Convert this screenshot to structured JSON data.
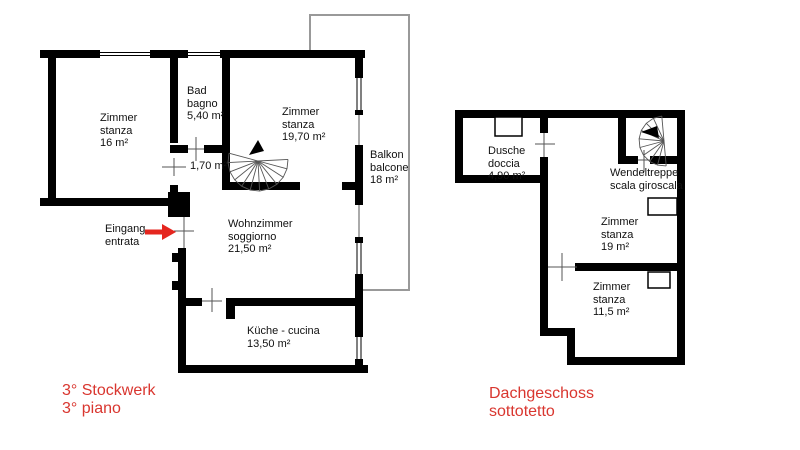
{
  "colors": {
    "wall": "#000000",
    "accent_red_text": "#d9362f",
    "arrow_red": "#e5261f",
    "balcony_outline": "#999999"
  },
  "left_plan": {
    "caption": {
      "line1": "3° Stockwerk",
      "line2": "3° piano"
    },
    "entrance": {
      "line1": "Eingang",
      "line2": "entrata"
    },
    "hallway_area": "1,70 m²",
    "rooms": [
      {
        "name_de": "Zimmer",
        "name_it": "stanza",
        "area": "16 m²"
      },
      {
        "name_de": "Bad",
        "name_it": "bagno",
        "area": "5,40 m²"
      },
      {
        "name_de": "Zimmer",
        "name_it": "stanza",
        "area": "19,70 m²"
      },
      {
        "name_de": "Balkon",
        "name_it": "balcone",
        "area": "18 m²"
      },
      {
        "name_de": "Wohnzimmer",
        "name_it": "soggiorno",
        "area": "21,50 m²"
      },
      {
        "name_de": "Küche - cucina",
        "name_it": "",
        "area": "13,50 m²"
      }
    ]
  },
  "right_plan": {
    "caption": {
      "line1": "Dachgeschoss",
      "line2": "sottotetto"
    },
    "stair_label": {
      "line1": "Wendeltreppe",
      "line2": "scala giroscala"
    },
    "rooms": [
      {
        "name_de": "Dusche",
        "name_it": "doccia",
        "area": "4,90 m²"
      },
      {
        "name_de": "Zimmer",
        "name_it": "stanza",
        "area": "19 m²"
      },
      {
        "name_de": "Zimmer",
        "name_it": "stanza",
        "area": "11,5 m²"
      }
    ]
  }
}
